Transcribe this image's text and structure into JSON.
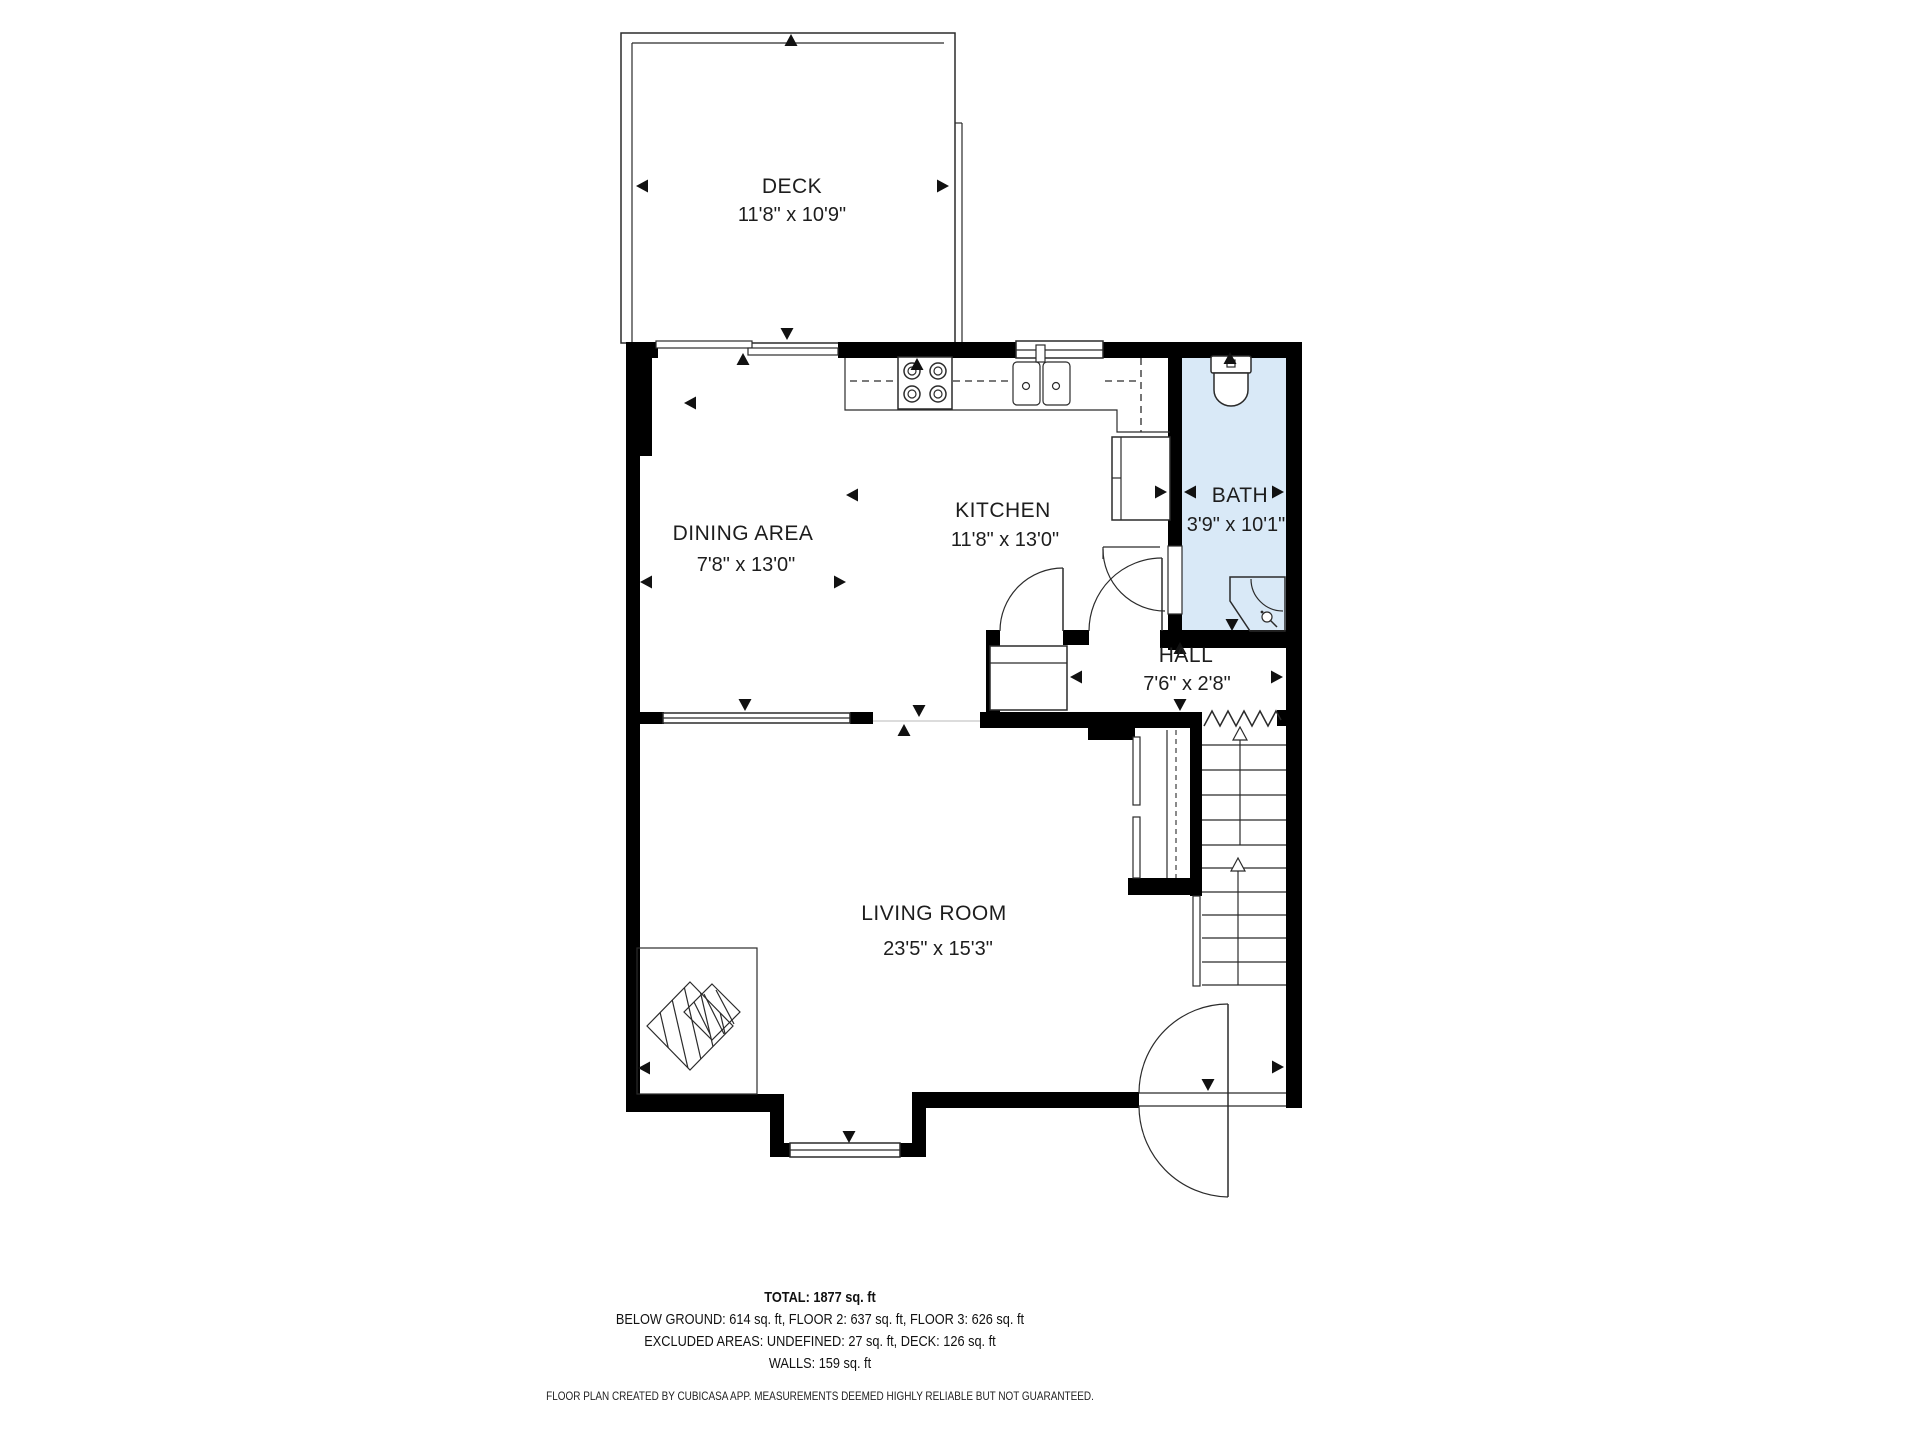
{
  "rooms": {
    "deck": {
      "label": "DECK",
      "dims": "11'8\" x 10'9\""
    },
    "dining": {
      "label": "DINING AREA",
      "dims": "7'8\" x 13'0\""
    },
    "kitchen": {
      "label": "KITCHEN",
      "dims": "11'8\" x 13'0\""
    },
    "bath": {
      "label": "BATH",
      "dims": "3'9\" x 10'1\""
    },
    "hall": {
      "label": "HALL",
      "dims": "7'6\" x 2'8\""
    },
    "living": {
      "label": "LIVING ROOM",
      "dims": "23'5\" x 15'3\""
    }
  },
  "summary": {
    "total": "TOTAL: 1877 sq. ft",
    "floors": "BELOW GROUND: 614 sq. ft, FLOOR 2: 637 sq. ft, FLOOR 3: 626 sq. ft",
    "excluded": "EXCLUDED AREAS: UNDEFINED: 27 sq. ft, DECK: 126 sq. ft",
    "walls": "WALLS: 159 sq. ft"
  },
  "disclaimer": "FLOOR PLAN CREATED BY CUBICASA APP. MEASUREMENTS DEEMED HIGHLY RELIABLE BUT NOT GUARANTEED.",
  "colors": {
    "wall": "#000000",
    "bath_fill": "#d9e9f7",
    "line": "#2b2b2b"
  }
}
